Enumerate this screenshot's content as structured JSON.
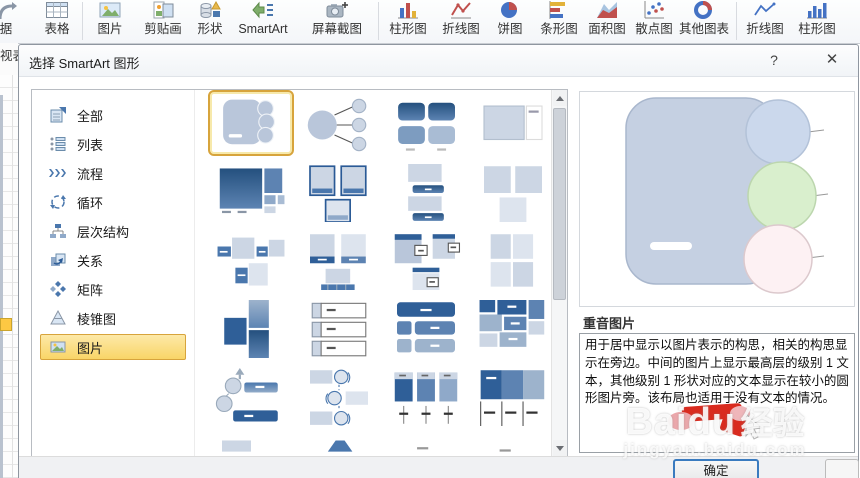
{
  "ribbon": {
    "buttons": [
      {
        "label": "据"
      },
      {
        "label": "表格"
      },
      {
        "label": "图片"
      },
      {
        "label": "剪贴画"
      },
      {
        "label": "形状"
      },
      {
        "label": "SmartArt"
      },
      {
        "label": "屏幕截图"
      },
      {
        "label": "柱形图"
      },
      {
        "label": "折线图"
      },
      {
        "label": "饼图"
      },
      {
        "label": "条形图"
      },
      {
        "label": "面积图"
      },
      {
        "label": "散点图"
      },
      {
        "label": "其他图表"
      },
      {
        "label": "折线图"
      },
      {
        "label": "柱形图"
      }
    ]
  },
  "worksheet": {
    "pivot_label_fragment": "视表"
  },
  "dialog": {
    "title": "选择 SmartArt 图形",
    "help_label": "?",
    "close_label": "✕",
    "categories": [
      {
        "label": "全部",
        "selected": false
      },
      {
        "label": "列表",
        "selected": false
      },
      {
        "label": "流程",
        "selected": false
      },
      {
        "label": "循环",
        "selected": false
      },
      {
        "label": "层次结构",
        "selected": false
      },
      {
        "label": "关系",
        "selected": false
      },
      {
        "label": "矩阵",
        "selected": false
      },
      {
        "label": "棱锥图",
        "selected": false
      },
      {
        "label": "图片",
        "selected": true
      }
    ],
    "preview": {
      "title": "重音图片",
      "description": "用于居中显示以图片表示的构思，相关的构思显示在旁边。中间的图片上显示最高层的级别 1 文本，其他级别 1 形状对应的文本显示在较小的圆形图片旁。该布局也适用于没有文本的情况。"
    },
    "ok_label": "确定"
  },
  "watermark": {
    "brand": "Baidu",
    "suffix": "经验",
    "url": "jingyan.baidu.com"
  },
  "colors": {
    "selection_yellow": "#fde28f",
    "selection_border": "#d7a43c",
    "annotation_red": "#d92b1f",
    "smartart_dark_blue": "#2a5a96",
    "smartart_pale_blue": "#ccd6e4"
  }
}
